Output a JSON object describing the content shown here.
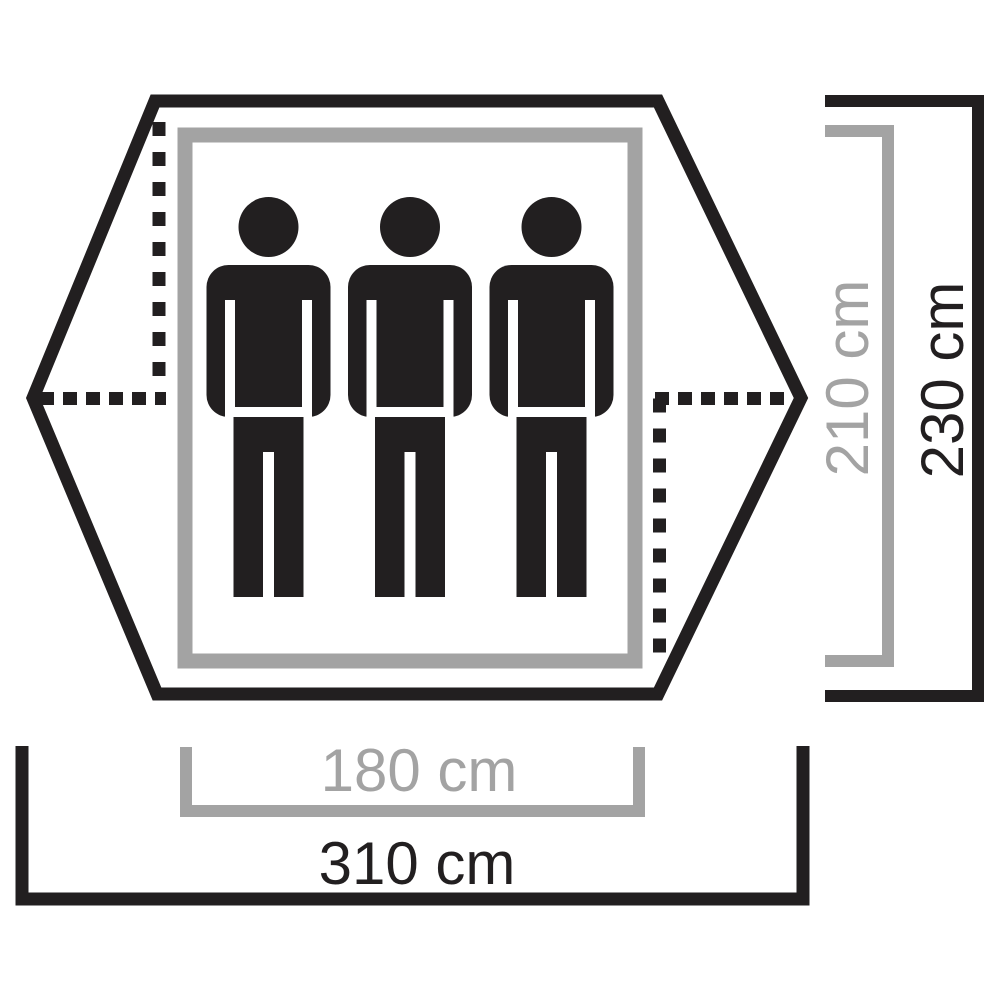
{
  "diagram": {
    "kind": "tent-floor-plan",
    "capacity_persons": 3
  },
  "dimensions": {
    "inner_width": "180 cm",
    "outer_width": "310 cm",
    "inner_depth": "210 cm",
    "outer_depth": "230 cm"
  },
  "colors": {
    "ink": "#221f20",
    "gray": "#a3a3a3",
    "paper": "#ffffff"
  }
}
